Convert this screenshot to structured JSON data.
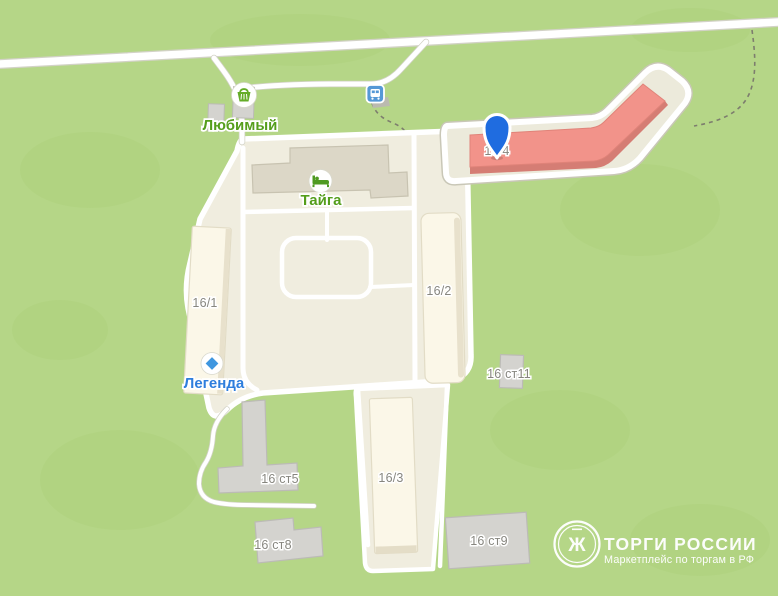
{
  "map_labels": {
    "lyubimy": "Любимый",
    "taiga": "Тайга",
    "legenda": "Легенда",
    "b16_1": "16/1",
    "b16_2": "16/2",
    "b16_3": "16/3",
    "b16_4": "16/4",
    "b16_s5": "16 ст5",
    "b16_s8": "16 ст8",
    "b16_s9": "16 ст9",
    "b16_s11": "16 ст11"
  },
  "poi": [
    {
      "name": "Любимый",
      "icon": "grocery-basket-icon",
      "color": "#559e1c"
    },
    {
      "name": "Тайга",
      "icon": "hotel-bed-icon",
      "color": "#559e1c"
    },
    {
      "name": "Легенда",
      "icon": "diamond-icon",
      "color": "#2e7edd"
    }
  ],
  "selected_building": {
    "label": "16/4",
    "marker": "map-pin"
  },
  "transit": {
    "bus_stop_icon": "bus-stop-icon"
  },
  "colors": {
    "grass": "#b5d687",
    "grass_shade": "#a8cd74",
    "road": "#ffffff",
    "road_casing": "#d2d2c6",
    "block": "#f0eddf",
    "building_light": "#fbf7e8",
    "building_gray": "#d4d3cf",
    "building_taiga": "#dcd7c7",
    "selected_building": "#f2938a",
    "selected_building_shade": "#d57d74",
    "platform": "#eceadb",
    "pin": "#1f6ce0",
    "poi_green": "#559e1c",
    "poi_blue": "#2e7edd",
    "label_gray": "#87867f",
    "bus_icon": "#5598d6",
    "watermark": "#ffffff"
  },
  "watermark": {
    "title": "ТОРГИ РОССИИ",
    "subtitle": "Маркетплейс по торгам в РФ",
    "eagle": "Ж"
  }
}
